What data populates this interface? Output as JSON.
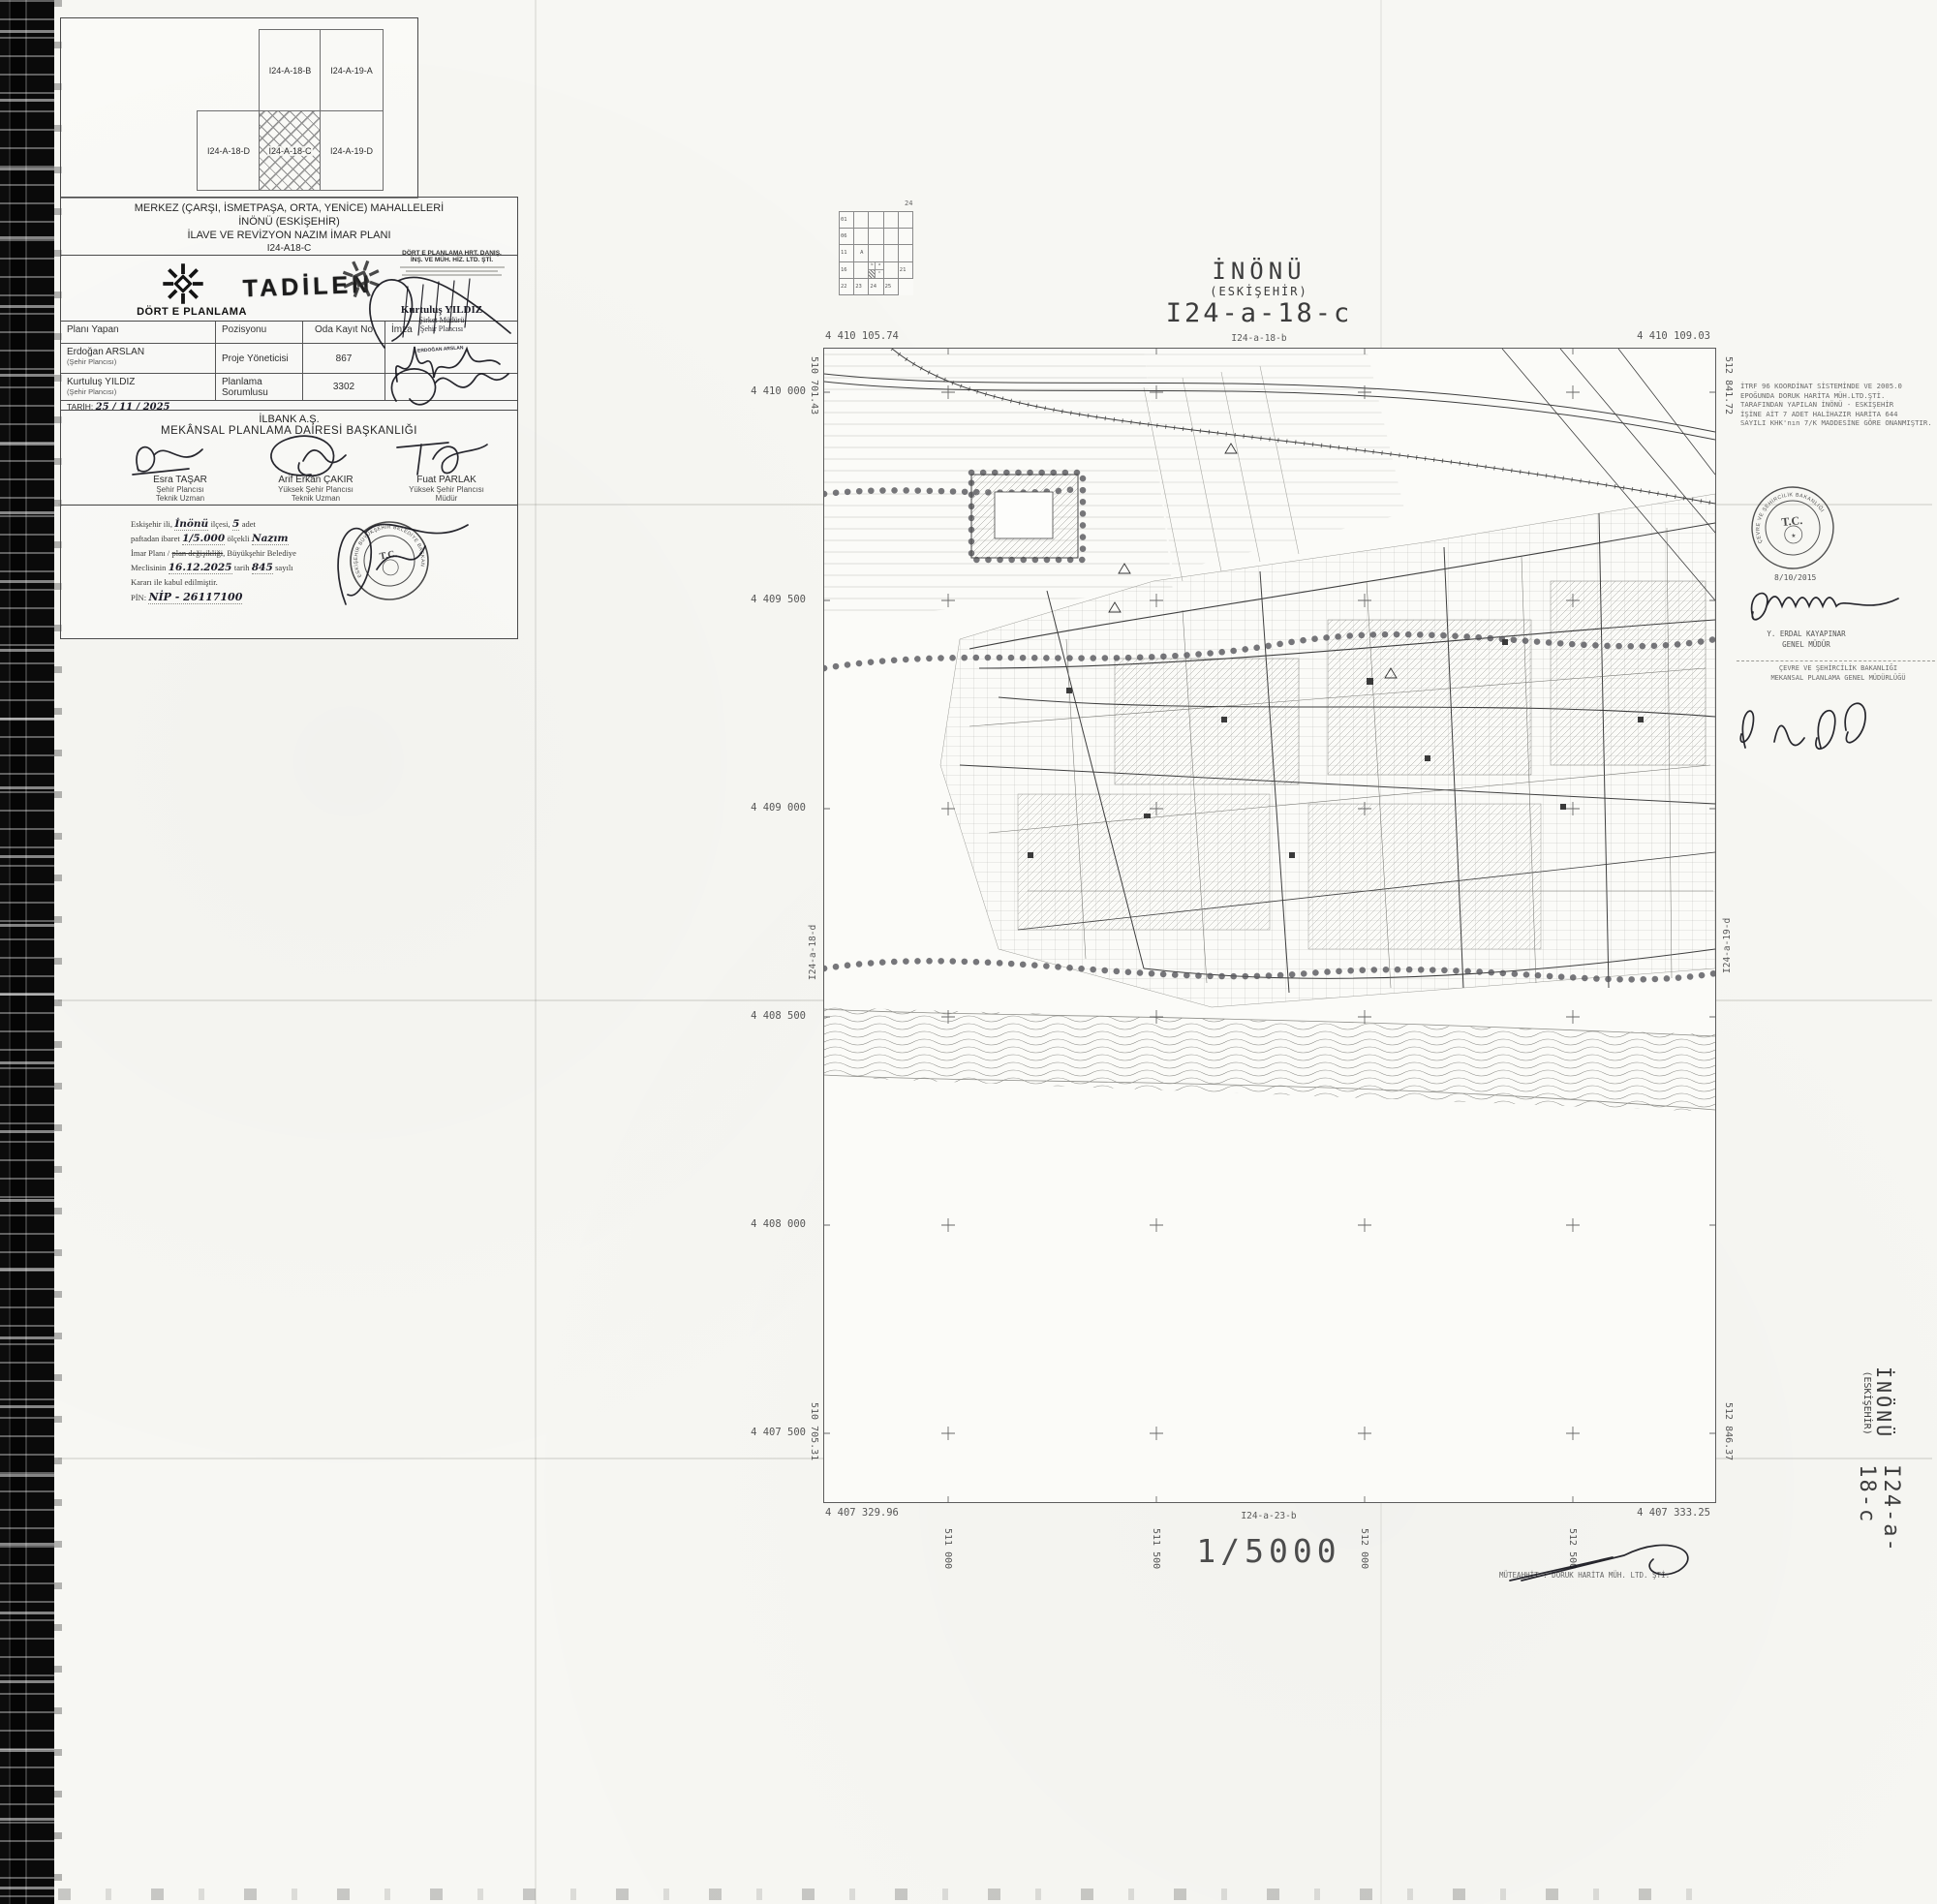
{
  "index_map": {
    "top_cells": [
      "I24-A-18-B",
      "I24-A-19-A"
    ],
    "bottom_cells": [
      "I24-A-18-D",
      "I24-A-18-C",
      "I24-A-19-D"
    ]
  },
  "title_block": {
    "line1": "MERKEZ (ÇARŞI, İSMETPAŞA, ORTA, YENİCE) MAHALLELERİ",
    "line2": "İNÖNÜ (ESKİŞEHİR)",
    "line3": "İLAVE VE REVİZYON NAZIM İMAR PLANI",
    "line4": "I24-A18-C"
  },
  "firm": {
    "logo_text": "DÖRT E PLANLAMA",
    "tadilen": "TADİLEN",
    "stamp_line1": "DÖRT E PLANLAMA HRT. DANIŞ.",
    "stamp_line2": "İNŞ. VE MÜH. HİZ. LTD. ŞTİ.",
    "stamp_name": "Kurtuluş YILDIZ",
    "stamp_role1": "Şirket Müdürü",
    "stamp_role2": "Şehir Plancısı"
  },
  "staff_table": {
    "headers": [
      "Planı Yapan",
      "Pozisyonu",
      "Oda Kayıt No",
      "İmza"
    ],
    "rows": [
      {
        "name": "Erdoğan ARSLAN",
        "title": "(Şehir Plancısı)",
        "position": "Proje Yöneticisi",
        "reg_no": "867"
      },
      {
        "name": "Kurtuluş YILDIZ",
        "title": "(Şehir Plancısı)",
        "position": "Planlama Sorumlusu",
        "reg_no": "3302"
      }
    ],
    "name_stamp": "ERDOĞAN ARSLAN",
    "date_label": "TARİH:",
    "date_value": "25 / 11 / 2025"
  },
  "ilbank": {
    "line1": "İLBANK A.Ş.",
    "line2": "MEKÂNSAL PLANLAMA DAİRESİ BAŞKANLIĞI",
    "signers": [
      {
        "name": "Esra TAŞAR",
        "role1": "Şehir Plancısı",
        "role2": "Teknik Uzman"
      },
      {
        "name": "Arif Erkan ÇAKIR",
        "role1": "Yüksek Şehir Plancısı",
        "role2": "Teknik Uzman"
      },
      {
        "name": "Fuat PARLAK",
        "role1": "Yüksek Şehir Plancısı",
        "role2": "Müdür"
      }
    ]
  },
  "approval": {
    "l1a": "Eskişehir ili,",
    "l1b": "İnönü",
    "l1c": "ilçesi,",
    "l1d": "5",
    "l1e": "adet",
    "l2a": "paftadan ibaret",
    "l2b": "1/5.000",
    "l2c": "ölçekli",
    "l2d": "Nazım",
    "l3a": "İmar Planı /",
    "l3b": "plan değişikliği",
    "l3c": ", Büyükşehir Belediye",
    "l4a": "Meclisinin",
    "l4b": "16.12.2025",
    "l4c": "tarih",
    "l4d": "845",
    "l4e": "sayılı",
    "l5": "Kararı ile kabul edilmiştir.",
    "l6a": "PİN:",
    "l6b": "NİP - 26117100",
    "seal_center": "T.C.",
    "seal_ring": "ESKİŞEHİR BÜYÜKŞEHİR BELEDİYE BAŞKANLIĞI"
  },
  "map": {
    "title1": "İNÖNÜ",
    "title2": "(ESKİŞEHİR)",
    "title3": "I24-a-18-c",
    "neighbor_top": "I24-a-18-b",
    "neighbor_bottom": "I24-a-23-b",
    "neighbor_left": "I24-a-18-d",
    "neighbor_right": "I24-a-19-d",
    "corner_tl": "4 410 105.74",
    "corner_tr": "4 410 109.03",
    "corner_bl": "4 407 329.96",
    "corner_br": "4 407 333.25",
    "edge_tl": "510 701.43",
    "edge_tr": "512 841.72",
    "edge_bl": "510 705.31",
    "edge_br": "512 846.37",
    "northings": [
      "4 410 000",
      "4 409 500",
      "4 409 000",
      "4 408 500",
      "4 408 000",
      "4 407 500"
    ],
    "eastings": [
      "511 000",
      "511 500",
      "512 000",
      "512 500"
    ],
    "locator": {
      "corner": "24",
      "row_labels": [
        "01",
        "06",
        "11",
        "16",
        "21"
      ],
      "bottom_labels": [
        "22",
        "23",
        "24",
        "25"
      ],
      "marked": "A",
      "sub_labels": [
        "b",
        "a",
        "c"
      ]
    }
  },
  "right_margin": {
    "itrf": [
      "İTRF 96 KOORDİNAT SİSTEMİNDE VE 2005.0",
      "EPOĞUNDA DORUK HARİTA MÜH.LTD.ŞTİ.",
      "TARAFINDAN YAPILAN İNÖNÜ - ESKİŞEHİR",
      "İŞİNE AİT 7 ADET HALİHAZIR HARİTA 644",
      "SAYILI KHK'nın 7/K MADDESİNE GÖRE ONANMIŞTIR."
    ],
    "seal_center": "T.C.",
    "seal_ring": "ÇEVRE VE ŞEHİRCİLİK BAKANLIĞI",
    "seal_date": "8/10/2015",
    "signer_name": "Y. ERDAL KAYAPINAR",
    "signer_role": "GENEL MÜDÜR",
    "ministry1": "ÇEVRE VE ŞEHİRCİLİK BAKANLIĞI",
    "ministry2": "MEKANSAL PLANLAMA GENEL MÜDÜRLÜĞÜ"
  },
  "footer": {
    "scale": "1/5000",
    "contractor": "MÜTEAHHİT :  DORUK HARİTA  MÜH.  LTD.  ŞTİ."
  },
  "side_label": {
    "l1": "İNÖNÜ",
    "l2": "(ESKİŞEHİR)",
    "l3": "I24-a-18-c"
  }
}
